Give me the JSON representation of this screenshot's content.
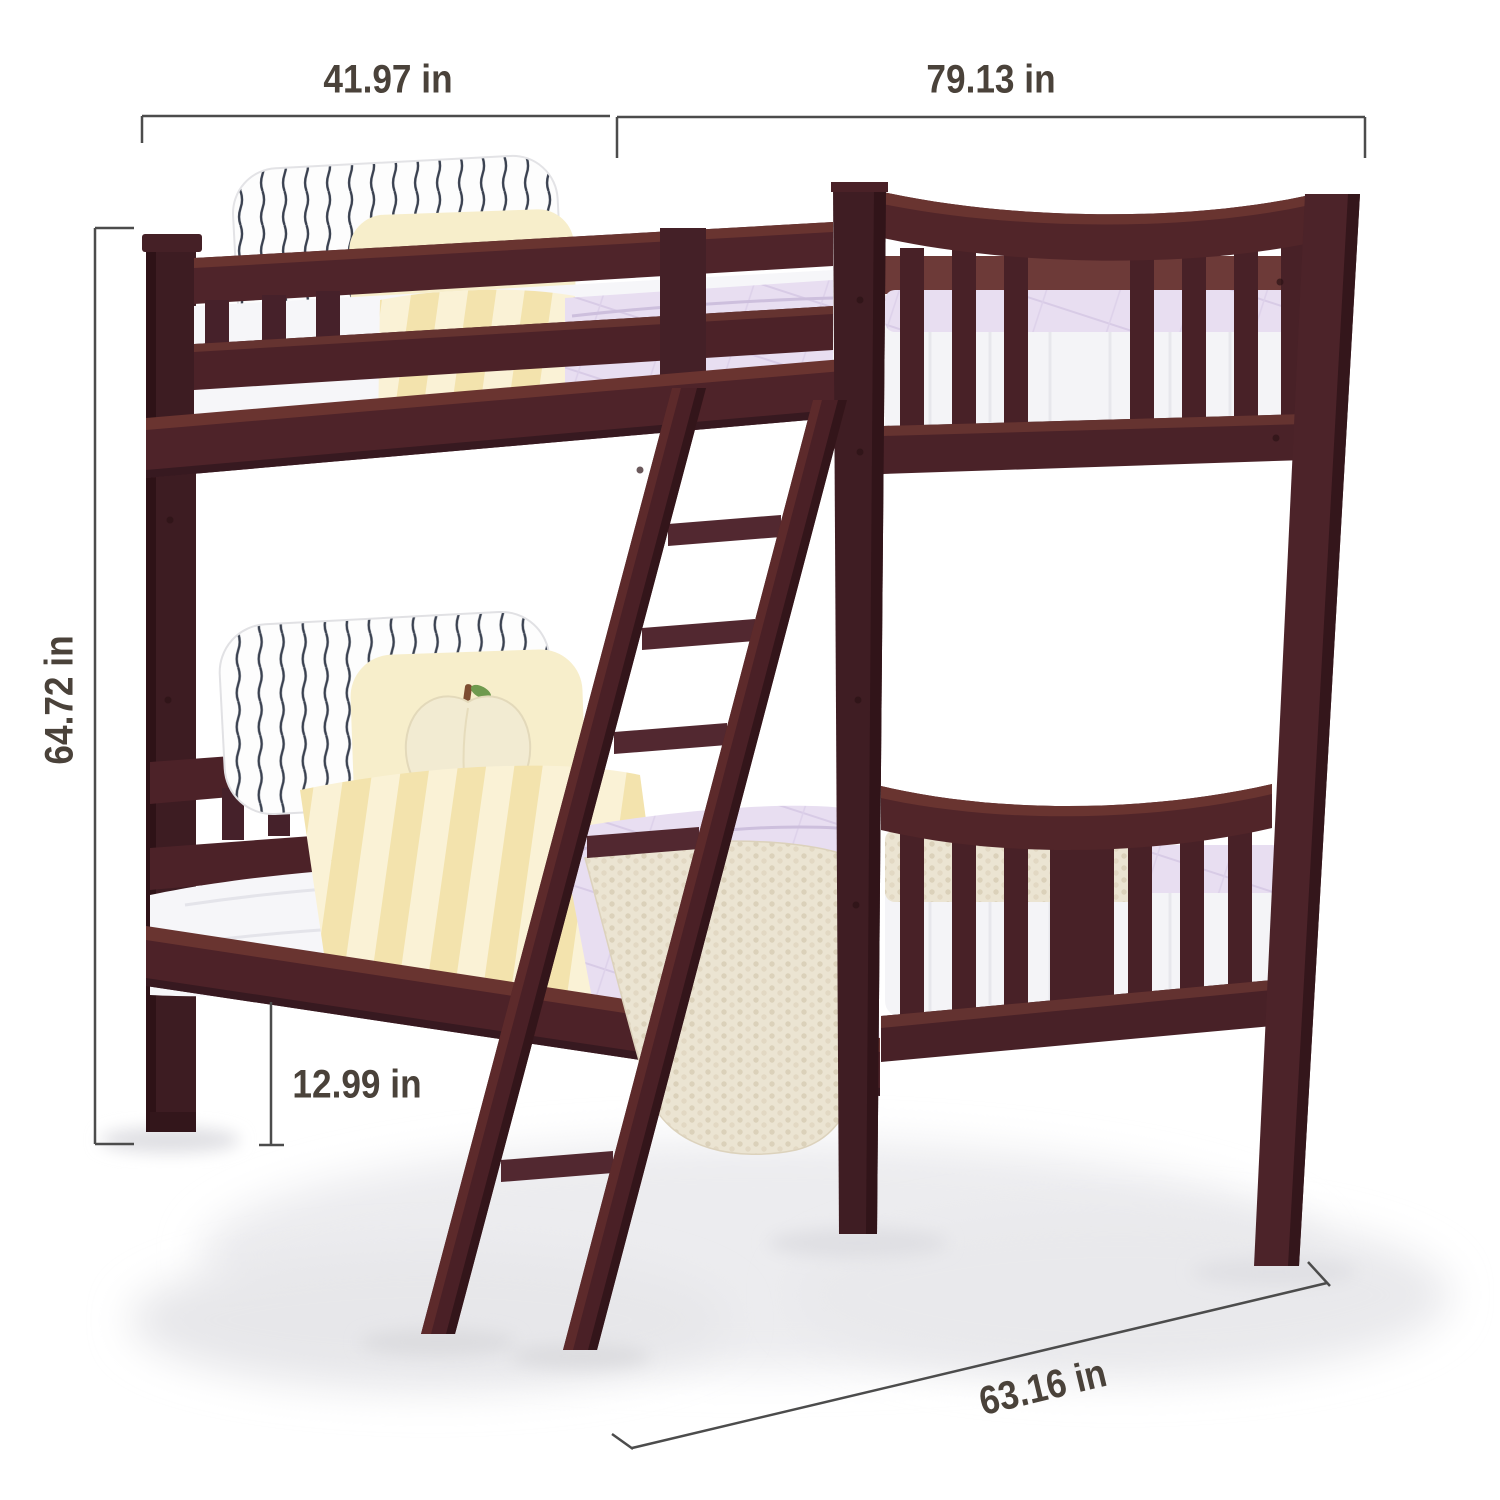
{
  "meta": {
    "subject": "Twin over twin espresso wood bunk bed with ladder, shown with dimension callouts",
    "type": "product-dimension-image"
  },
  "dimension_labels": {
    "width_top": "41.97 in",
    "length_top": "79.13 in",
    "height_left": "64.72 in",
    "clearance": "12.99 in",
    "depth_bottom": "63.16 in"
  },
  "colors": {
    "background": "#ffffff",
    "dimension_line": "#4c4c4c",
    "dimension_text": "#4a423a",
    "wood_dark": "#3f1c22",
    "wood_mid": "#4e2329",
    "wood_highlight": "#6a3430",
    "mattress": "#f4f4f7",
    "comforter_lavender": "#e8def1",
    "blanket_yellow": "#f3e3ad",
    "pillow_stripe": "#3a4150",
    "pillow_cream": "#f7eecb",
    "knit_blanket": "#ebe4d2"
  }
}
